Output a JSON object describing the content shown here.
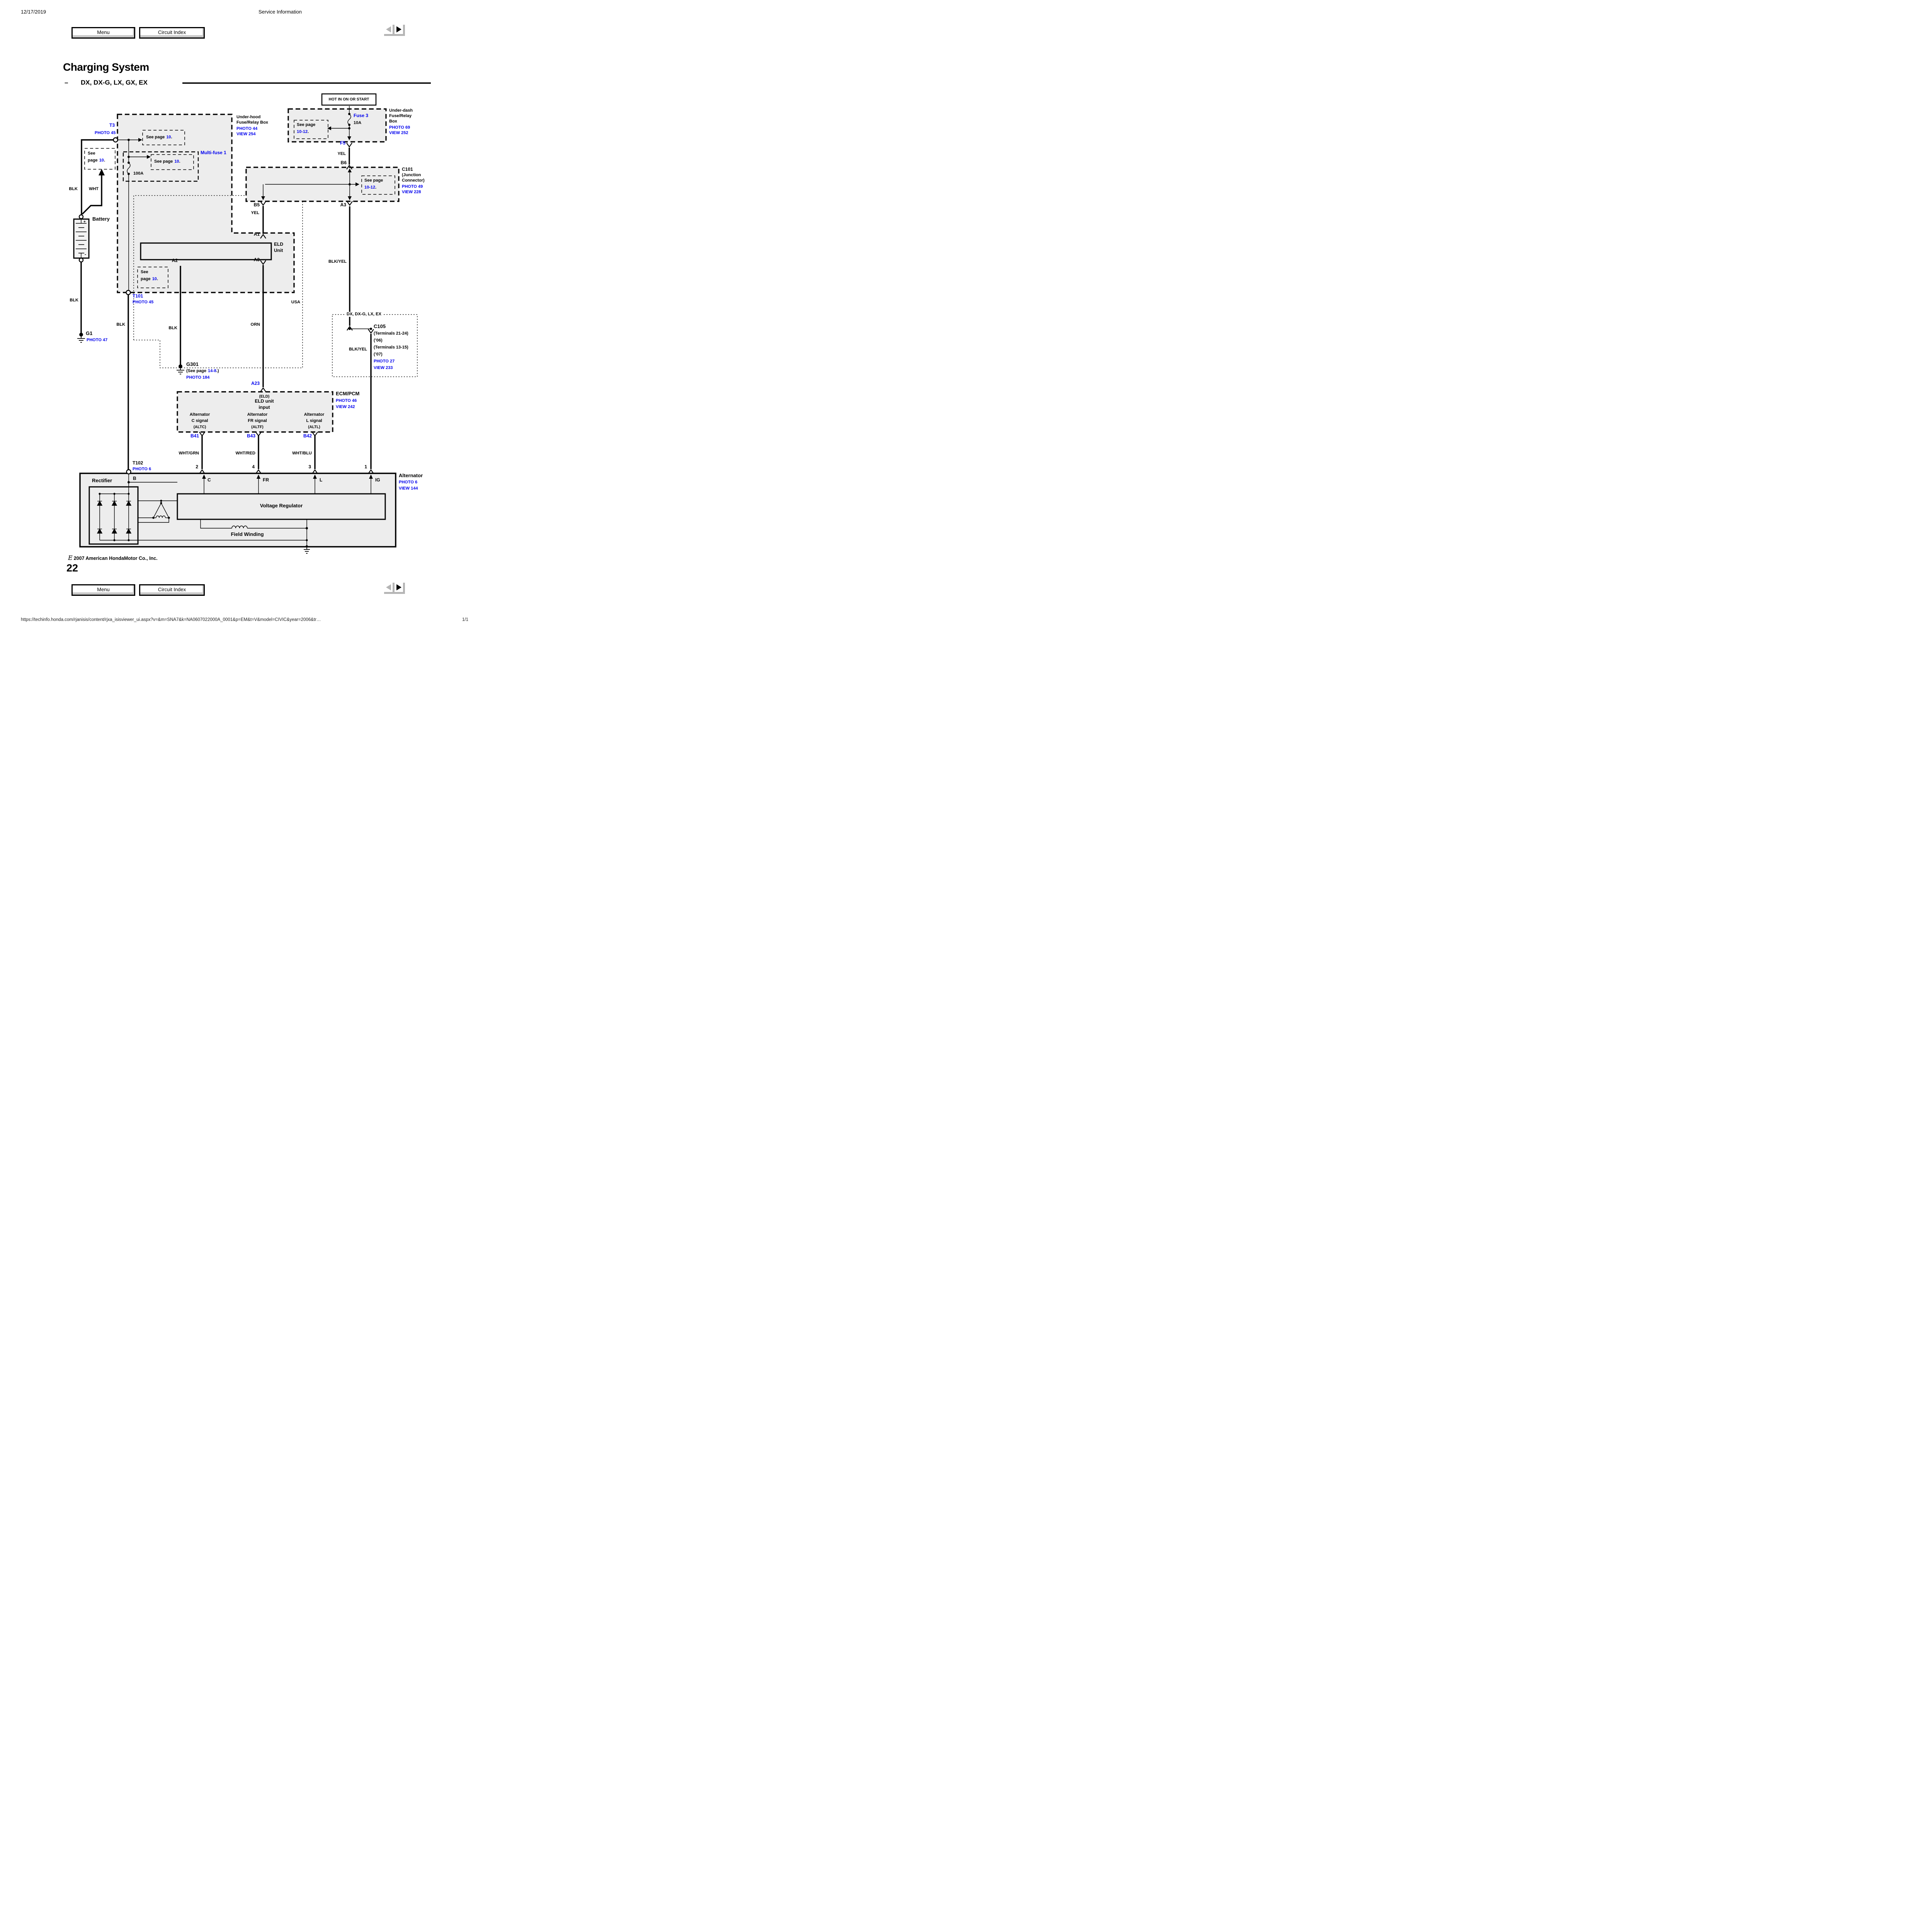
{
  "header": {
    "date": "12/17/2019",
    "app_title": "Service Information",
    "menu": "Menu",
    "circuit_index": "Circuit Index"
  },
  "title": {
    "main": "Charging System",
    "dash": "–",
    "models": "DX, DX-G, LX, GX, EX"
  },
  "d": {
    "hot": "HOT IN ON OR START",
    "underdash": {
      "l1": "Under-dash",
      "l2": "Fuse/Relay",
      "l3": "Box",
      "photo": "PHOTO 69",
      "view": "VIEW 252",
      "fuse": "Fuse 3",
      "amp": "10A",
      "f5": "F5",
      "yel": "YEL",
      "b6": "B6"
    },
    "ref": {
      "seepage": "See page",
      "see": "See",
      "page": "page",
      "p10": "10",
      "p1012": "10-12",
      "p148": "14-8",
      "dot": ".",
      "g301pre": "(See page",
      "g301suf": ".)"
    },
    "c101": {
      "name": "C101",
      "l2": "(Junction",
      "l3": "Connector)",
      "photo": "PHOTO 49",
      "view": "VIEW 228",
      "b5": "B5",
      "a3": "A3",
      "yel": "YEL"
    },
    "underhood": {
      "l1": "Under-hood",
      "l2": "Fuse/Relay Box",
      "photo": "PHOTO 44",
      "view": "VIEW 254",
      "t3": "T3",
      "t3photo": "PHOTO 45",
      "multifuse": "Multi-fuse 1",
      "amp": "100A",
      "blk": "BLK",
      "wht": "WHT"
    },
    "battery": {
      "name": "Battery",
      "plus": "+",
      "minus": "-"
    },
    "g1": {
      "name": "G1",
      "photo": "PHOTO 47",
      "blk": "BLK"
    },
    "t101": {
      "name": "T101",
      "photo": "PHOTO 45",
      "blk": "BLK"
    },
    "eld": {
      "a1": "A1",
      "a2": "A2",
      "a3": "A3",
      "n1": "ELD",
      "n2": "Unit",
      "blk": "BLK",
      "orn": "ORN",
      "blkyel": "BLK/YEL"
    },
    "usa": "USA",
    "g301": {
      "name": "G301",
      "photo": "PHOTO 184"
    },
    "a23": "A23",
    "dx": {
      "region": "DX, DX-G, LX, EX",
      "c105": "C105",
      "t1": "(Terminals 21-24)",
      "y06": "(’06)",
      "t2": "(Terminals 13-15)",
      "y07": "(’07)",
      "photo": "PHOTO 27",
      "view": "VIEW 233",
      "blkyel": "BLK/YEL"
    },
    "ecm": {
      "name": "ECM/PCM",
      "photo": "PHOTO 46",
      "view": "VIEW 242",
      "eldp": "(ELD)",
      "eldunit": "ELD unit",
      "input": "input",
      "alt": "Alternator",
      "csig": "C signal",
      "altc": "(ALTC)",
      "frsig": "FR signal",
      "altf": "(ALTF)",
      "lsig": "L signal",
      "altl": "(ALTL)",
      "b41": "B41",
      "b43": "B43",
      "b42": "B42"
    },
    "wires": {
      "whtgrn": "WHT/GRN",
      "whtred": "WHT/RED",
      "whtblu": "WHT/BLU"
    },
    "t102": {
      "name": "T102",
      "photo": "PHOTO 6"
    },
    "alt": {
      "n2": "2",
      "n4": "4",
      "n3": "3",
      "n1": "1",
      "name": "Alternator",
      "photo": "PHOTO 6",
      "view": "VIEW 144",
      "rectifier": "Rectifier",
      "b": "B",
      "c": "C",
      "fr": "FR",
      "l": "L",
      "ig": "IG",
      "vr": "Voltage Regulator",
      "fw": "Field Winding"
    }
  },
  "footer": {
    "copy_sym": "E",
    "copyright": "2007 American HondaMotor Co., Inc.",
    "page_number": "22",
    "url": "https://techinfo.honda.com/rjanisis/content/rjxa_isisviewer_ui.aspx?v=&m=SNA7&k=NA0607022000A_0001&p=EM&t=V&model=CIVIC&year=2006&tr…",
    "page_indicator": "1/1"
  }
}
